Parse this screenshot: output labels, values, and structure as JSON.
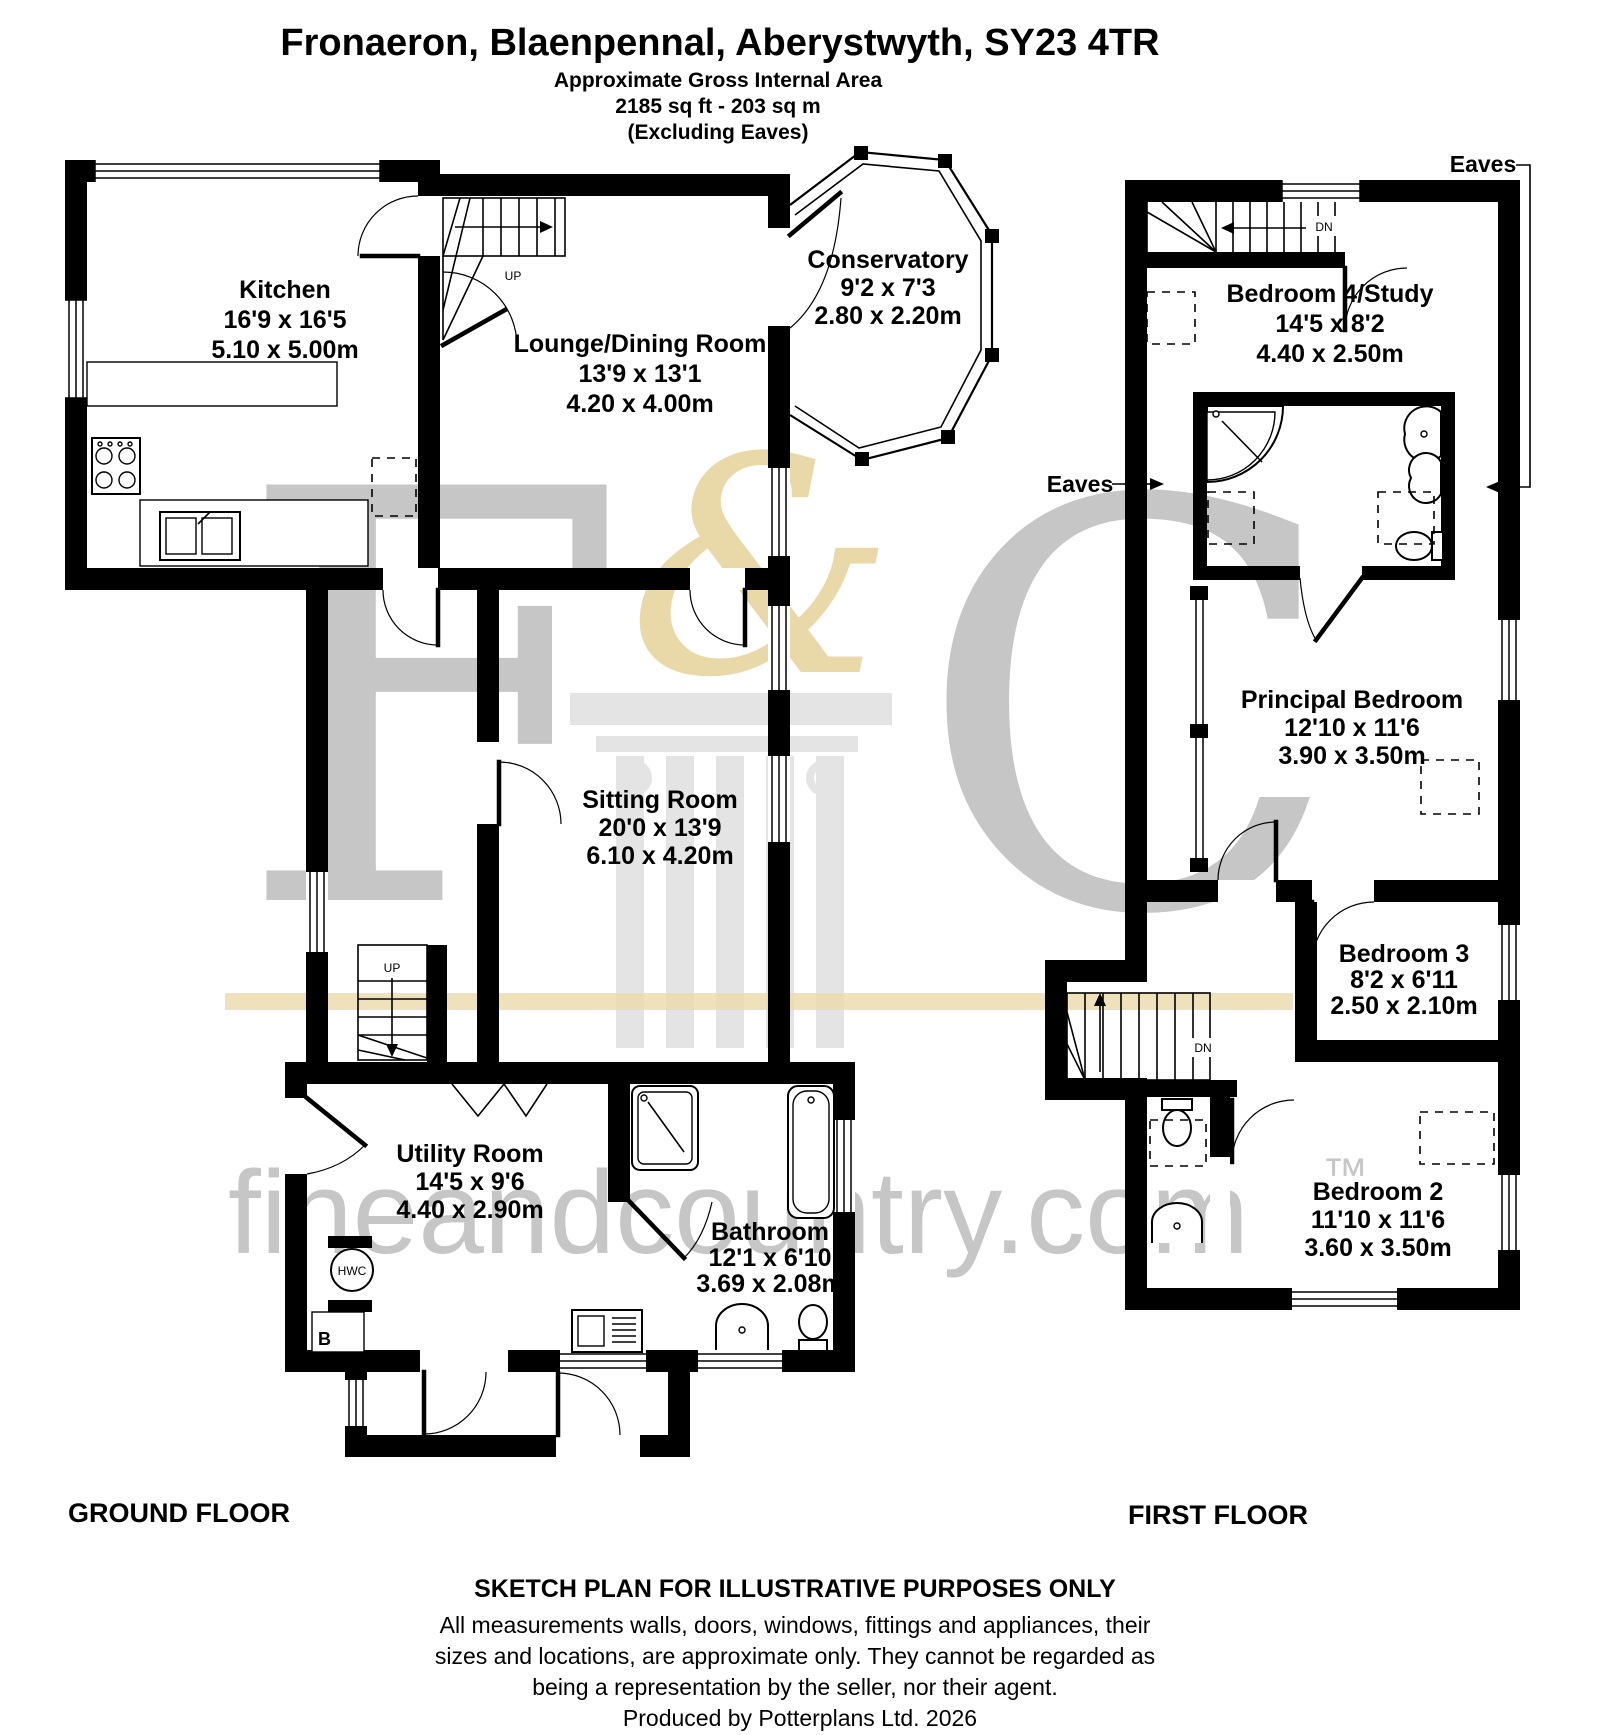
{
  "header": {
    "title": "Fronaeron, Blaenpennal, Aberystwyth, SY23 4TR",
    "subtitle": "Approximate Gross Internal Area",
    "area": "2185 sq ft - 203 sq m",
    "area_note": "(Excluding Eaves)"
  },
  "ground_floor": {
    "label": "GROUND FLOOR",
    "rooms": {
      "kitchen": {
        "name": "Kitchen",
        "imperial": "16'9 x 16'5",
        "metric": "5.10 x 5.00m"
      },
      "lounge_dining": {
        "name": "Lounge/Dining Room",
        "imperial": "13'9 x 13'1",
        "metric": "4.20 x 4.00m"
      },
      "conservatory": {
        "name": "Conservatory",
        "imperial": "9'2 x 7'3",
        "metric": "2.80 x 2.20m"
      },
      "sitting_room": {
        "name": "Sitting Room",
        "imperial": "20'0 x 13'9",
        "metric": "6.10 x 4.20m"
      },
      "utility_room": {
        "name": "Utility Room",
        "imperial": "14'5 x 9'6",
        "metric": "4.40 x 2.90m"
      },
      "bathroom": {
        "name": "Bathroom",
        "imperial": "12'1 x 6'10",
        "metric": "3.69 x 2.08m"
      }
    },
    "annotations": {
      "up": "UP",
      "hot_water_cylinder": "HWC",
      "boiler": "B"
    }
  },
  "first_floor": {
    "label": "FIRST FLOOR",
    "rooms": {
      "bedroom4_study": {
        "name": "Bedroom 4/Study",
        "imperial": "14'5 x 8'2",
        "metric": "4.40 x 2.50m"
      },
      "principal_bedroom": {
        "name": "Principal Bedroom",
        "imperial": "12'10 x 11'6",
        "metric": "3.90 x 3.50m"
      },
      "bedroom3": {
        "name": "Bedroom 3",
        "imperial": "8'2 x 6'11",
        "metric": "2.50 x 2.10m"
      },
      "bedroom2": {
        "name": "Bedroom 2",
        "imperial": "11'10 x 11'6",
        "metric": "3.60 x 3.50m"
      }
    },
    "annotations": {
      "dn": "DN",
      "eaves": "Eaves"
    }
  },
  "footer": {
    "floor_note": "SKETCH PLAN FOR ILLUSTRATIVE PURPOSES ONLY",
    "disclaimer_line1": "All measurements walls, doors, windows, fittings and appliances, their",
    "disclaimer_line2": "sizes and locations, are approximate only. They cannot be regarded as",
    "disclaimer_line3": "being a representation by the seller, nor their agent.",
    "credit": "Produced by Potterplans Ltd. 2026"
  },
  "watermark": {
    "letter_f": "F",
    "ampersand": "&",
    "letter_c": "C",
    "domain": "fineandcountry.com",
    "trademark": "™"
  },
  "colors": {
    "wall": "#000000",
    "watermark_gray": "#c6c6c6",
    "watermark_beige": "#e9d8a8",
    "watermark_light": "#e4e4e4"
  }
}
